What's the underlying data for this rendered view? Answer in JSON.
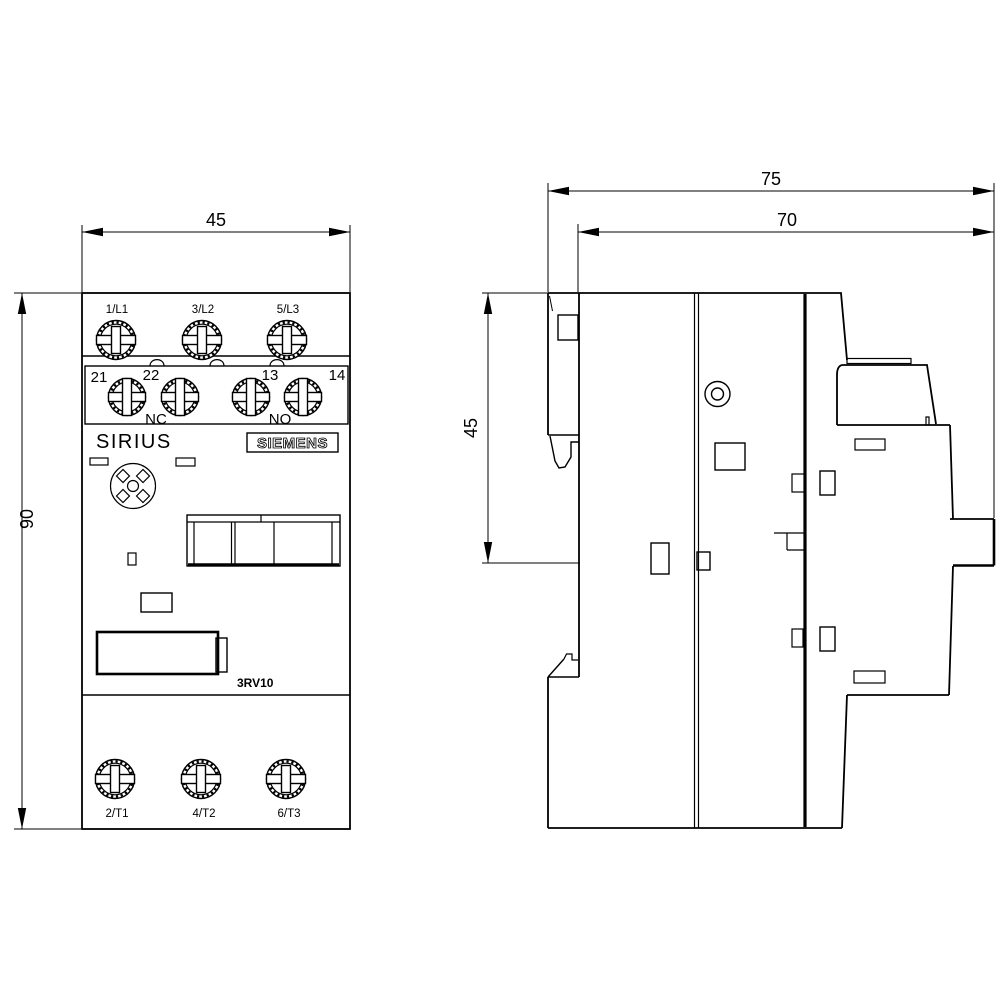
{
  "drawing": {
    "type": "technical-dimension-drawing",
    "colors": {
      "line": "#000000",
      "background": "#ffffff"
    }
  },
  "front_view": {
    "width_dim": "45",
    "height_dim": "90",
    "line_terminals": [
      "1/L1",
      "3/L2",
      "5/L3"
    ],
    "aux_terminals": [
      "21",
      "22",
      "13",
      "14"
    ],
    "aux_contact_labels": [
      "NC",
      "NO"
    ],
    "brand": "SIRIUS",
    "logo": "SIEMENS",
    "model": "3RV10",
    "load_terminals": [
      "2/T1",
      "4/T2",
      "6/T3"
    ]
  },
  "side_view": {
    "overall_depth_dim": "75",
    "body_depth_dim": "70",
    "clip_height_dim": "45"
  }
}
